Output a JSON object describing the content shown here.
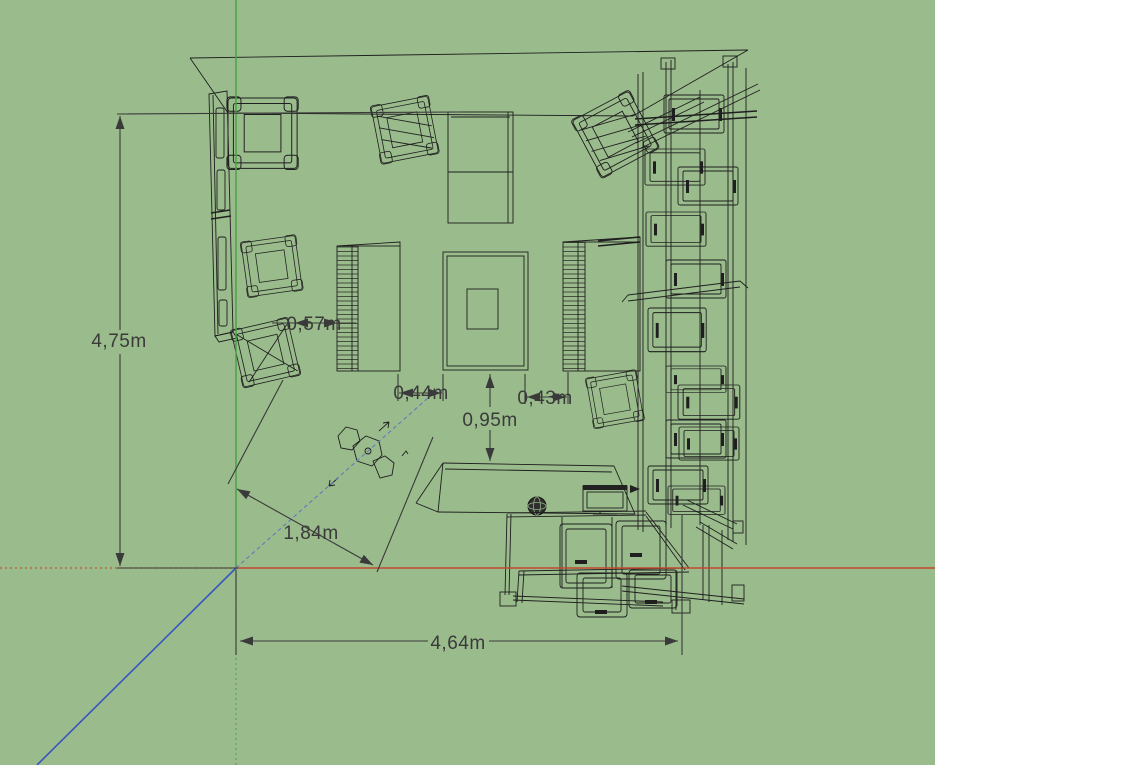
{
  "viewport": {
    "background": "#9abb8c",
    "side_panel": "#ffffff",
    "wireframe_color": "#1f1f1f",
    "dimension_text_color": "#3a3a3a"
  },
  "axes": {
    "x_color": "#c0492e",
    "y_color": "#4aa145",
    "z_color": "#3b55c0",
    "inference_color": "#5d74c4",
    "origin": {
      "x": 236,
      "y": 568
    }
  },
  "dimensions": {
    "room_height": {
      "label": "4,75m"
    },
    "chair_to_shelf": {
      "label": "0,57m"
    },
    "shelf_to_table": {
      "label": "0,44m"
    },
    "table_to_shelf": {
      "label": "0,43m"
    },
    "table_to_console": {
      "label": "0,95m"
    },
    "diagonal_gap": {
      "label": "1,84m"
    },
    "room_width": {
      "label": "4,64m"
    }
  },
  "scene": {
    "view": "top-view wireframe floor plan of furnished room",
    "objects": [
      "left-wardrobe",
      "cube-armchair",
      "tilted-armchair",
      "slat-shelf-left",
      "slat-shelf-right",
      "sofa",
      "coffee-table",
      "office-chair",
      "drawer-column",
      "console-sideboard",
      "desk",
      "monitor",
      "globe-ornament"
    ]
  }
}
